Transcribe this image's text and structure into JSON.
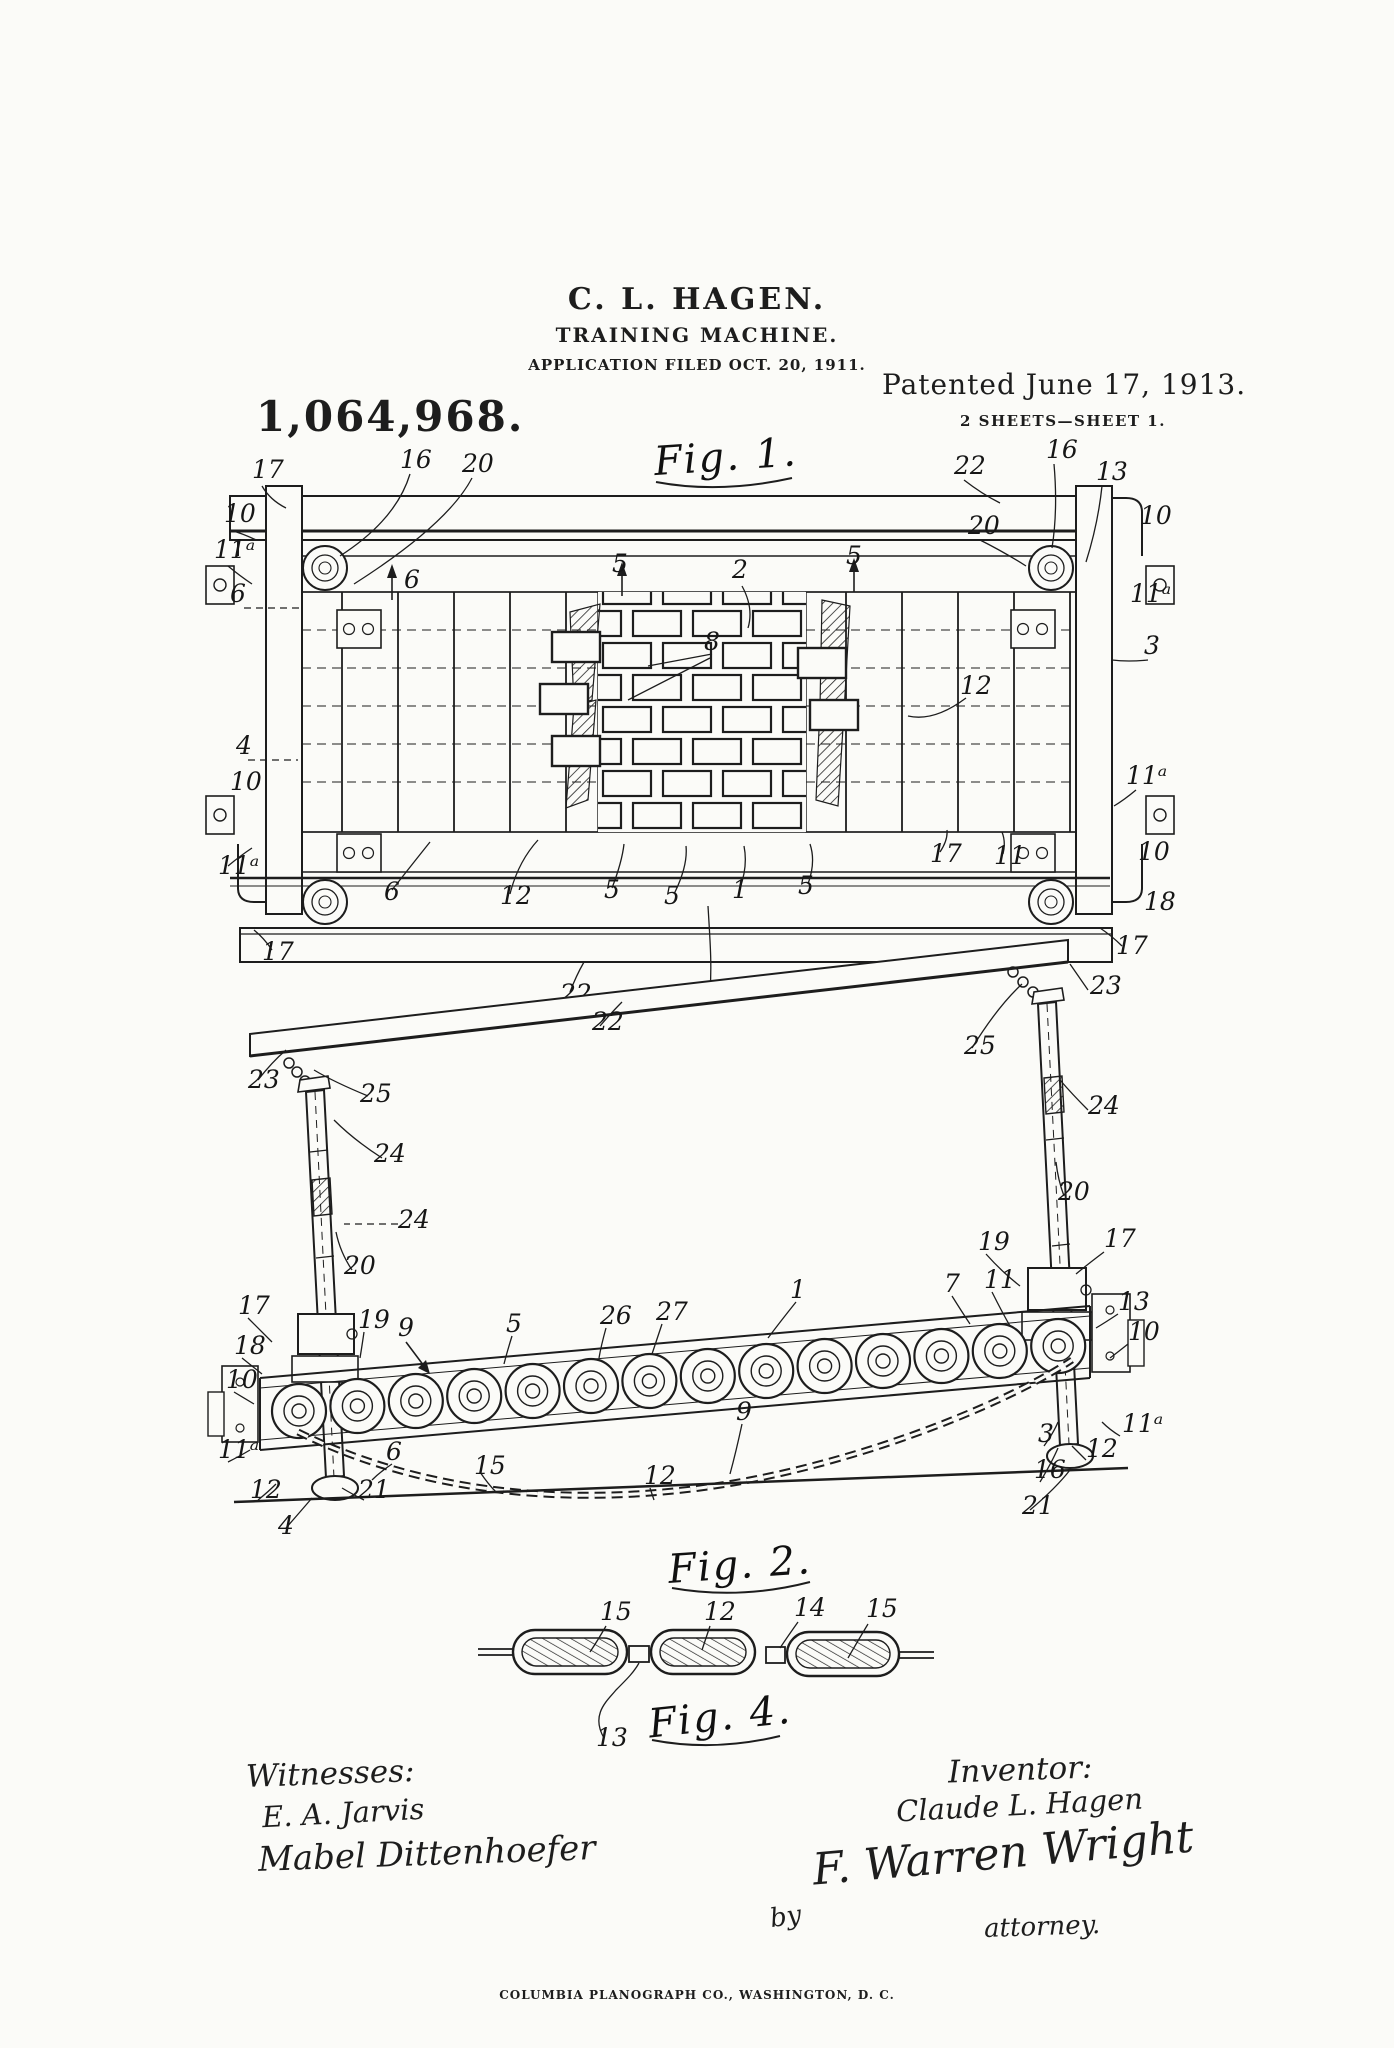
{
  "header": {
    "inventor_name": "C. L. HAGEN.",
    "title": "TRAINING MACHINE.",
    "application_line": "APPLICATION FILED OCT. 20, 1911.",
    "patent_number": "1,064,968.",
    "patented_line": "Patented June 17, 1913.",
    "sheet_line": "2 SHEETS—SHEET 1."
  },
  "figures": {
    "fig1": {
      "caption": "Fig. 1.",
      "labels": [
        {
          "t": "17",
          "x": 252,
          "y": 478
        },
        {
          "t": "16",
          "x": 400,
          "y": 468
        },
        {
          "t": "20",
          "x": 462,
          "y": 472
        },
        {
          "t": "22",
          "x": 954,
          "y": 474
        },
        {
          "t": "16",
          "x": 1046,
          "y": 458
        },
        {
          "t": "13",
          "x": 1096,
          "y": 480
        },
        {
          "t": "10",
          "x": 224,
          "y": 522
        },
        {
          "t": "11ᵃ",
          "x": 214,
          "y": 558
        },
        {
          "t": "20",
          "x": 968,
          "y": 534
        },
        {
          "t": "10",
          "x": 1140,
          "y": 524
        },
        {
          "t": "6",
          "x": 404,
          "y": 588
        },
        {
          "t": "5",
          "x": 612,
          "y": 572
        },
        {
          "t": "2",
          "x": 732,
          "y": 578
        },
        {
          "t": "5",
          "x": 846,
          "y": 564
        },
        {
          "t": "11ᵃ",
          "x": 1130,
          "y": 602
        },
        {
          "t": "6",
          "x": 230,
          "y": 602
        },
        {
          "t": "3",
          "x": 1144,
          "y": 654
        },
        {
          "t": "8",
          "x": 704,
          "y": 650
        },
        {
          "t": "12",
          "x": 960,
          "y": 694
        },
        {
          "t": "4",
          "x": 236,
          "y": 754
        },
        {
          "t": "10",
          "x": 230,
          "y": 790
        },
        {
          "t": "11ᵃ",
          "x": 1126,
          "y": 784
        },
        {
          "t": "11ᵃ",
          "x": 218,
          "y": 874
        },
        {
          "t": "10",
          "x": 1138,
          "y": 860
        },
        {
          "t": "6",
          "x": 384,
          "y": 900
        },
        {
          "t": "12",
          "x": 500,
          "y": 904
        },
        {
          "t": "5",
          "x": 604,
          "y": 898
        },
        {
          "t": "5",
          "x": 664,
          "y": 904
        },
        {
          "t": "1",
          "x": 732,
          "y": 898
        },
        {
          "t": "5",
          "x": 798,
          "y": 894
        },
        {
          "t": "17",
          "x": 930,
          "y": 862
        },
        {
          "t": "11",
          "x": 994,
          "y": 864
        },
        {
          "t": "18",
          "x": 1144,
          "y": 910
        },
        {
          "t": "17",
          "x": 1116,
          "y": 954
        },
        {
          "t": "17",
          "x": 262,
          "y": 960
        },
        {
          "t": "22",
          "x": 560,
          "y": 1002
        },
        {
          "t": "26",
          "x": 700,
          "y": 1002
        }
      ]
    },
    "fig2": {
      "caption": "Fig. 2.",
      "labels": [
        {
          "t": "23",
          "x": 248,
          "y": 1088
        },
        {
          "t": "23",
          "x": 1090,
          "y": 994
        },
        {
          "t": "25",
          "x": 360,
          "y": 1102
        },
        {
          "t": "25",
          "x": 964,
          "y": 1054
        },
        {
          "t": "24",
          "x": 374,
          "y": 1162
        },
        {
          "t": "24",
          "x": 398,
          "y": 1228
        },
        {
          "t": "20",
          "x": 344,
          "y": 1274
        },
        {
          "t": "22",
          "x": 592,
          "y": 1030
        },
        {
          "t": "24",
          "x": 1088,
          "y": 1114
        },
        {
          "t": "20",
          "x": 1058,
          "y": 1200
        },
        {
          "t": "19",
          "x": 978,
          "y": 1250
        },
        {
          "t": "17",
          "x": 1104,
          "y": 1247
        },
        {
          "t": "7",
          "x": 944,
          "y": 1292
        },
        {
          "t": "11",
          "x": 984,
          "y": 1288
        },
        {
          "t": "13",
          "x": 1118,
          "y": 1310
        },
        {
          "t": "10",
          "x": 1128,
          "y": 1340
        },
        {
          "t": "17",
          "x": 238,
          "y": 1314
        },
        {
          "t": "19",
          "x": 358,
          "y": 1328
        },
        {
          "t": "9",
          "x": 398,
          "y": 1336
        },
        {
          "t": "5",
          "x": 506,
          "y": 1332
        },
        {
          "t": "26",
          "x": 600,
          "y": 1324
        },
        {
          "t": "27",
          "x": 656,
          "y": 1320
        },
        {
          "t": "1",
          "x": 790,
          "y": 1298
        },
        {
          "t": "18",
          "x": 234,
          "y": 1354
        },
        {
          "t": "10",
          "x": 226,
          "y": 1388
        },
        {
          "t": "11ᵃ",
          "x": 218,
          "y": 1458
        },
        {
          "t": "12",
          "x": 250,
          "y": 1498
        },
        {
          "t": "21",
          "x": 358,
          "y": 1498
        },
        {
          "t": "6",
          "x": 386,
          "y": 1460
        },
        {
          "t": "15",
          "x": 474,
          "y": 1474
        },
        {
          "t": "12",
          "x": 644,
          "y": 1484
        },
        {
          "t": "9",
          "x": 736,
          "y": 1420
        },
        {
          "t": "11ᵃ",
          "x": 1122,
          "y": 1432
        },
        {
          "t": "12",
          "x": 1086,
          "y": 1457
        },
        {
          "t": "3",
          "x": 1038,
          "y": 1442
        },
        {
          "t": "16",
          "x": 1034,
          "y": 1478
        },
        {
          "t": "21",
          "x": 1022,
          "y": 1514
        },
        {
          "t": "4",
          "x": 278,
          "y": 1534
        }
      ]
    },
    "fig4": {
      "caption": "Fig. 4.",
      "labels": [
        {
          "t": "15",
          "x": 600,
          "y": 1620
        },
        {
          "t": "12",
          "x": 704,
          "y": 1620
        },
        {
          "t": "14",
          "x": 794,
          "y": 1616
        },
        {
          "t": "15",
          "x": 866,
          "y": 1617
        },
        {
          "t": "13",
          "x": 596,
          "y": 1746
        }
      ]
    }
  },
  "signatures": {
    "witnesses_heading": "Witnesses:",
    "witness1": "E. A. Jarvis",
    "witness2": "Mabel Dittenhoefer",
    "inventor_heading": "Inventor:",
    "inventor_name": "Claude L. Hagen",
    "by_label": "by",
    "attorney_signature": "F. Warren Wright",
    "attorney_label": "attorney."
  },
  "footer": {
    "printer_line": "COLUMBIA PLANOGRAPH CO., WASHINGTON, D. C."
  }
}
